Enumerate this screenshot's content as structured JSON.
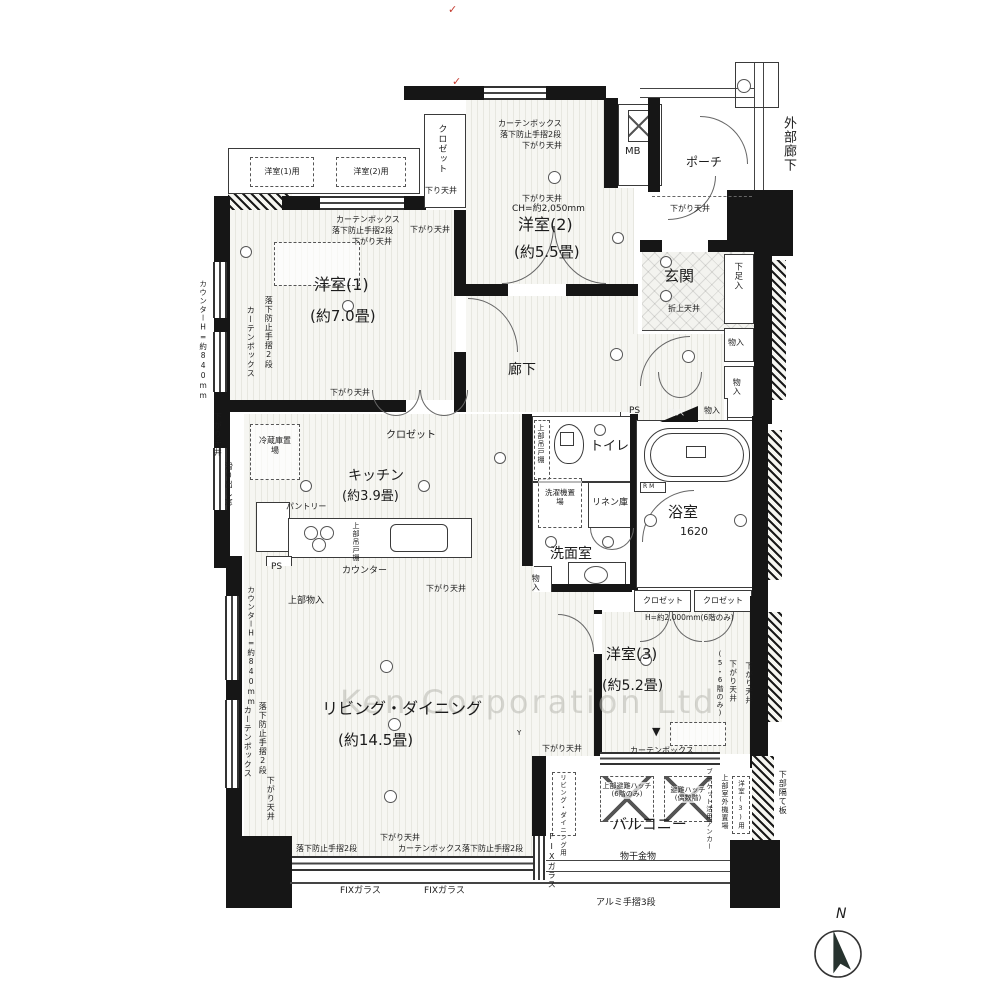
{
  "meta": {
    "watermark": "Ken Corporation Ltd",
    "compass_n": "N",
    "red_check": "✓"
  },
  "rooms": {
    "yoshitsu1": {
      "name": "洋室(1)",
      "size": "(約7.0畳)"
    },
    "yoshitsu2": {
      "name": "洋室(2)",
      "size": "(約5.5畳)",
      "ch": "CH=約2,050mm"
    },
    "yoshitsu3": {
      "name": "洋室(3)",
      "size": "(約5.2畳)"
    },
    "living": {
      "name": "リビング・ダイニング",
      "size": "(約14.5畳)"
    },
    "kitchen": {
      "name": "キッチン",
      "size": "(約3.9畳)"
    },
    "genkan": {
      "name": "玄関",
      "ceiling": "折上天井"
    },
    "rouka": {
      "name": "廊下"
    },
    "toilet": {
      "name": "トイレ"
    },
    "senmen": {
      "name": "洗面室"
    },
    "bath": {
      "name": "浴室",
      "size": "1620"
    },
    "balcony": {
      "name": "バルコニー"
    },
    "porch": {
      "name": "ポーチ"
    },
    "gaibu_rouka": {
      "name": "外部廊下"
    }
  },
  "storage": {
    "closet": "クロゼット",
    "monoire": "物入",
    "getabako": "下足入",
    "pantry": "パントリー",
    "linen": "リネン庫",
    "joubu_monoire": "上部物入",
    "joubu_tsuridana": "上部吊戸棚",
    "reizouko": "冷蔵庫置場",
    "sentakuki": "洗濯機置場"
  },
  "fixtures": {
    "ps": "PS",
    "mb": "MB",
    "counter": "カウンター",
    "monohoshi": "物干金物",
    "rm": "R M"
  },
  "notes": {
    "sagari_tenjo": "下がり天井",
    "sagari_tenjo_s": "下り天井",
    "curtain_box": "カーテンボックス",
    "rakka_boshi": "落下防止手摺2段",
    "fix_glass": "FIXガラス",
    "alumi_tesuri": "アルミ手摺3段",
    "counter_h": "カウンターH=約840mm",
    "suberidashi": "滑り出し窓",
    "h2000": "H=約2,000mm(6階のみ)",
    "floor56": "(5・6階のみ)",
    "hinan_upper": "上部避難ハッチ(6階のみ)",
    "hinan": "避難ハッチ(偶数階)",
    "outdoor_unit": "上部室外機置場",
    "outdoor_y1": "洋室(1)用",
    "outdoor_y2": "洋室(2)用",
    "outdoor_y3": "洋室(3)用",
    "outdoor_ld": "リビング・ダイニング用",
    "anchor": "ブラケット活用アンカー",
    "hedate": "下部隔て板",
    "down_marker": "▼",
    "y_box": "Y"
  }
}
